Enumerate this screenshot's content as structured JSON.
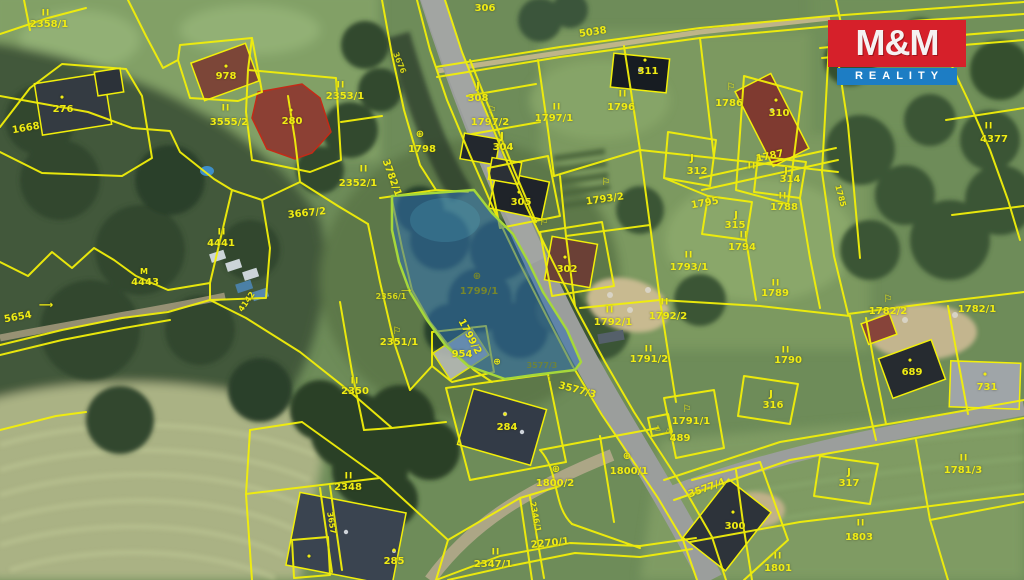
{
  "logo": {
    "title": "M&M",
    "subtitle": "REALITY",
    "red": "#d6202a",
    "blue": "#1d7dc4"
  },
  "map": {
    "highlighted_parcel": {
      "number": "1799/1",
      "fill": "#2f6fb4",
      "border": "#a6d83a"
    },
    "line_color": "#f2ef0a",
    "labels": [
      {
        "t": "II",
        "x": 46,
        "y": 14,
        "c": "sym"
      },
      {
        "t": "2358/1",
        "x": 49,
        "y": 25
      },
      {
        "t": "•",
        "x": 62,
        "y": 99,
        "c": "dot"
      },
      {
        "t": "276",
        "x": 63,
        "y": 110
      },
      {
        "t": "1668",
        "x": 26,
        "y": 129,
        "r": -10
      },
      {
        "t": "•",
        "x": 226,
        "y": 68,
        "c": "dot"
      },
      {
        "t": "978",
        "x": 226,
        "y": 77
      },
      {
        "t": "II",
        "x": 226,
        "y": 109,
        "c": "sym"
      },
      {
        "t": "3555/2",
        "x": 229,
        "y": 123
      },
      {
        "t": "•",
        "x": 291,
        "y": 112,
        "c": "dot"
      },
      {
        "t": "280",
        "x": 292,
        "y": 122
      },
      {
        "t": "II",
        "x": 341,
        "y": 86,
        "c": "sym"
      },
      {
        "t": "2353/1",
        "x": 345,
        "y": 97
      },
      {
        "t": "3676",
        "x": 399,
        "y": 63,
        "r": 68,
        "s": 8,
        "c": "faint"
      },
      {
        "t": "306",
        "x": 485,
        "y": 9
      },
      {
        "t": "5038",
        "x": 593,
        "y": 33,
        "r": -8
      },
      {
        "t": "•",
        "x": 645,
        "y": 62,
        "c": "dot"
      },
      {
        "t": "311",
        "x": 648,
        "y": 72
      },
      {
        "t": "II",
        "x": 623,
        "y": 95,
        "c": "sym"
      },
      {
        "t": "1796",
        "x": 621,
        "y": 108
      },
      {
        "t": "⚐",
        "x": 731,
        "y": 88,
        "c": "icon"
      },
      {
        "t": "1786",
        "x": 729,
        "y": 104
      },
      {
        "t": "•",
        "x": 776,
        "y": 102,
        "c": "dot"
      },
      {
        "t": "310",
        "x": 779,
        "y": 114
      },
      {
        "t": "J",
        "x": 478,
        "y": 87,
        "c": "icon"
      },
      {
        "t": "308",
        "x": 478,
        "y": 99
      },
      {
        "t": "⚐",
        "x": 492,
        "y": 111,
        "c": "icon"
      },
      {
        "t": "1797/2",
        "x": 490,
        "y": 123
      },
      {
        "t": "II",
        "x": 557,
        "y": 108,
        "c": "sym"
      },
      {
        "t": "1797/1",
        "x": 554,
        "y": 119
      },
      {
        "t": "J",
        "x": 502,
        "y": 137,
        "c": "icon"
      },
      {
        "t": "304",
        "x": 503,
        "y": 148
      },
      {
        "t": "⊕",
        "x": 420,
        "y": 135,
        "c": "icon"
      },
      {
        "t": "1798",
        "x": 422,
        "y": 150
      },
      {
        "t": "3782/1",
        "x": 391,
        "y": 178,
        "r": 70
      },
      {
        "t": "II",
        "x": 364,
        "y": 170,
        "c": "sym"
      },
      {
        "t": "2352/1",
        "x": 358,
        "y": 184
      },
      {
        "t": "3667/2",
        "x": 307,
        "y": 214,
        "r": -6
      },
      {
        "t": "II",
        "x": 222,
        "y": 233,
        "c": "sym"
      },
      {
        "t": "4441",
        "x": 221,
        "y": 244
      },
      {
        "t": "M",
        "x": 144,
        "y": 272,
        "c": "icon",
        "s": 8
      },
      {
        "t": "4443",
        "x": 145,
        "y": 283
      },
      {
        "t": "⟶",
        "x": 46,
        "y": 306,
        "c": "icon"
      },
      {
        "t": "5654",
        "x": 18,
        "y": 318,
        "r": -10
      },
      {
        "t": "4142",
        "x": 247,
        "y": 302,
        "r": -55,
        "s": 8
      },
      {
        "t": "•",
        "x": 519,
        "y": 194,
        "c": "dot"
      },
      {
        "t": "305",
        "x": 521,
        "y": 203
      },
      {
        "t": "⚐",
        "x": 544,
        "y": 223,
        "c": "icon"
      },
      {
        "t": "•",
        "x": 565,
        "y": 259,
        "c": "dot"
      },
      {
        "t": "302",
        "x": 567,
        "y": 270
      },
      {
        "t": "⊕",
        "x": 477,
        "y": 277,
        "c": "icon olive"
      },
      {
        "t": "1799/1",
        "x": 479,
        "y": 292,
        "c": "olive"
      },
      {
        "t": "2356/1",
        "x": 391,
        "y": 297,
        "s": 8,
        "c": "faint"
      },
      {
        "t": "⟶",
        "x": 406,
        "y": 291,
        "s": 7,
        "c": "icon faint"
      },
      {
        "t": "⚐",
        "x": 397,
        "y": 332,
        "c": "icon"
      },
      {
        "t": "2351/1",
        "x": 399,
        "y": 343
      },
      {
        "t": "1799/2",
        "x": 469,
        "y": 337,
        "r": 62
      },
      {
        "t": "954",
        "x": 462,
        "y": 355
      },
      {
        "t": "⊕",
        "x": 497,
        "y": 363,
        "c": "icon",
        "s": 9
      },
      {
        "t": "3577/3",
        "x": 542,
        "y": 366,
        "s": 8,
        "c": "faint olive"
      },
      {
        "t": "↑",
        "x": 550,
        "y": 379,
        "s": 8,
        "c": "faint olive"
      },
      {
        "t": "3577/3",
        "x": 577,
        "y": 391,
        "r": 15
      },
      {
        "t": "II",
        "x": 355,
        "y": 382,
        "c": "sym"
      },
      {
        "t": "2350",
        "x": 355,
        "y": 392
      },
      {
        "t": "II",
        "x": 349,
        "y": 477,
        "c": "sym"
      },
      {
        "t": "2348",
        "x": 348,
        "y": 488
      },
      {
        "t": "3657",
        "x": 331,
        "y": 523,
        "r": 80,
        "s": 8
      },
      {
        "t": "•",
        "x": 505,
        "y": 416,
        "c": "dot"
      },
      {
        "t": "284",
        "x": 507,
        "y": 428
      },
      {
        "t": "•",
        "x": 309,
        "y": 558,
        "c": "dot"
      },
      {
        "t": "•",
        "x": 394,
        "y": 552,
        "c": "dot"
      },
      {
        "t": "285",
        "x": 394,
        "y": 562
      },
      {
        "t": "II",
        "x": 496,
        "y": 553,
        "c": "sym"
      },
      {
        "t": "2347/1",
        "x": 493,
        "y": 565
      },
      {
        "t": "2346/1",
        "x": 535,
        "y": 517,
        "r": 79,
        "s": 8
      },
      {
        "t": "2270/1",
        "x": 550,
        "y": 544,
        "r": -6
      },
      {
        "t": "⊕",
        "x": 556,
        "y": 470,
        "c": "icon"
      },
      {
        "t": "1800/2",
        "x": 555,
        "y": 484
      },
      {
        "t": "⊕",
        "x": 627,
        "y": 457,
        "c": "icon"
      },
      {
        "t": "1800/1",
        "x": 629,
        "y": 472
      },
      {
        "t": "△",
        "x": 658,
        "y": 428,
        "c": "icon",
        "s": 7
      },
      {
        "t": "△",
        "x": 668,
        "y": 431,
        "c": "icon",
        "s": 7
      },
      {
        "t": "489",
        "x": 680,
        "y": 439
      },
      {
        "t": "⚐",
        "x": 687,
        "y": 410,
        "c": "icon"
      },
      {
        "t": "1791/1",
        "x": 691,
        "y": 422
      },
      {
        "t": "3577/4",
        "x": 707,
        "y": 489,
        "r": -20
      },
      {
        "t": "•",
        "x": 733,
        "y": 514,
        "c": "dot"
      },
      {
        "t": "300",
        "x": 735,
        "y": 527
      },
      {
        "t": "II",
        "x": 778,
        "y": 557,
        "c": "sym"
      },
      {
        "t": "1801",
        "x": 778,
        "y": 569
      },
      {
        "t": "II",
        "x": 861,
        "y": 524,
        "c": "sym"
      },
      {
        "t": "1803",
        "x": 859,
        "y": 538
      },
      {
        "t": "J",
        "x": 849,
        "y": 473,
        "c": "icon"
      },
      {
        "t": "317",
        "x": 849,
        "y": 484
      },
      {
        "t": "II",
        "x": 964,
        "y": 459,
        "c": "sym"
      },
      {
        "t": "1781/3",
        "x": 963,
        "y": 471
      },
      {
        "t": "•",
        "x": 985,
        "y": 376,
        "c": "dot"
      },
      {
        "t": "731",
        "x": 987,
        "y": 388
      },
      {
        "t": "•",
        "x": 910,
        "y": 362,
        "c": "dot"
      },
      {
        "t": "689",
        "x": 912,
        "y": 373
      },
      {
        "t": "⚐",
        "x": 888,
        "y": 300,
        "c": "icon"
      },
      {
        "t": "1782/2",
        "x": 888,
        "y": 312
      },
      {
        "t": "1782/1",
        "x": 977,
        "y": 310
      },
      {
        "t": "II",
        "x": 786,
        "y": 351,
        "c": "sym"
      },
      {
        "t": "1790",
        "x": 788,
        "y": 361
      },
      {
        "t": "J",
        "x": 771,
        "y": 395,
        "c": "icon"
      },
      {
        "t": "316",
        "x": 773,
        "y": 406
      },
      {
        "t": "II",
        "x": 776,
        "y": 284,
        "c": "sym"
      },
      {
        "t": "1789",
        "x": 775,
        "y": 294
      },
      {
        "t": "II",
        "x": 783,
        "y": 197,
        "c": "sym"
      },
      {
        "t": "1788",
        "x": 784,
        "y": 208
      },
      {
        "t": "II",
        "x": 744,
        "y": 236,
        "c": "sym"
      },
      {
        "t": "1794",
        "x": 742,
        "y": 248
      },
      {
        "t": "II",
        "x": 689,
        "y": 256,
        "c": "sym"
      },
      {
        "t": "1793/1",
        "x": 689,
        "y": 268
      },
      {
        "t": "⚐",
        "x": 606,
        "y": 183,
        "c": "icon"
      },
      {
        "t": "1793/2",
        "x": 605,
        "y": 200,
        "r": -8
      },
      {
        "t": "II",
        "x": 610,
        "y": 311,
        "c": "sym"
      },
      {
        "t": "1792/1",
        "x": 613,
        "y": 323
      },
      {
        "t": "II",
        "x": 665,
        "y": 303,
        "c": "sym"
      },
      {
        "t": "1792/2",
        "x": 668,
        "y": 317
      },
      {
        "t": "II",
        "x": 649,
        "y": 350,
        "c": "sym"
      },
      {
        "t": "1791/2",
        "x": 649,
        "y": 360
      },
      {
        "t": "1795",
        "x": 705,
        "y": 204,
        "r": -10
      },
      {
        "t": "J",
        "x": 736,
        "y": 216,
        "c": "icon"
      },
      {
        "t": "315",
        "x": 735,
        "y": 226
      },
      {
        "t": "J",
        "x": 786,
        "y": 172,
        "c": "icon"
      },
      {
        "t": "314",
        "x": 790,
        "y": 180
      },
      {
        "t": "J",
        "x": 692,
        "y": 159,
        "c": "icon"
      },
      {
        "t": "312",
        "x": 697,
        "y": 172
      },
      {
        "t": "II",
        "x": 752,
        "y": 167,
        "c": "sym"
      },
      {
        "t": "1787",
        "x": 770,
        "y": 157,
        "r": -12
      },
      {
        "t": "1785",
        "x": 840,
        "y": 196,
        "r": 75,
        "s": 8
      },
      {
        "t": "II",
        "x": 989,
        "y": 127,
        "c": "sym"
      },
      {
        "t": "4377",
        "x": 994,
        "y": 140
      }
    ]
  }
}
